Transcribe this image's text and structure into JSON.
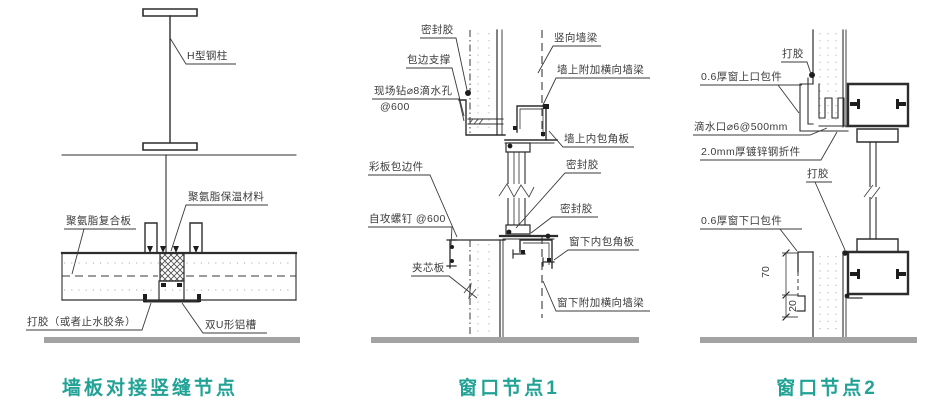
{
  "colors": {
    "title_teal": "#21a295",
    "line": "#2d2d2d",
    "ground_gray": "#a3a3a3"
  },
  "panels": [
    {
      "title": "墙板对接竖缝节点",
      "labels": {
        "h_steel_column": "H型钢柱",
        "pu_insulation": "聚氨脂保温材料",
        "pu_composite_panel": "聚氨脂复合板",
        "seal_glue": "打胶（或者止水胶条）",
        "double_u_channel": "双U形铝槽"
      }
    },
    {
      "title": "窗口节点1",
      "labels": {
        "sealant_top": "密封胶",
        "edge_support": "包边支撑",
        "drip_hole_line1": "现场钻⌀8滴水孔",
        "drip_hole_line2": "@600",
        "color_panel_trim": "彩板包边件",
        "self_tapping_screw": "自攻螺钉 @600",
        "sandwich_panel": "夹芯板",
        "vertical_wall_beam": "竖向墙梁",
        "wall_add_beam": "墙上附加横向墙梁",
        "wall_inner_corner": "墙上内包角板",
        "sealant_mid": "密封胶",
        "sealant_sill": "密封胶",
        "sill_inner_corner": "窗下内包角板",
        "sill_add_beam": "窗下附加横向墙梁"
      }
    },
    {
      "title": "窗口节点2",
      "labels": {
        "glue_top": "打胶",
        "head_trim": "0.6厚窗上口包件",
        "drip_outlet": "滴水口⌀6@500mm",
        "galv_fold": "2.0mm厚镀锌钢折件",
        "glue_mid": "打胶",
        "sill_trim": "0.6厚窗下口包件",
        "dim_70": "70",
        "dim_20": "20"
      }
    }
  ]
}
